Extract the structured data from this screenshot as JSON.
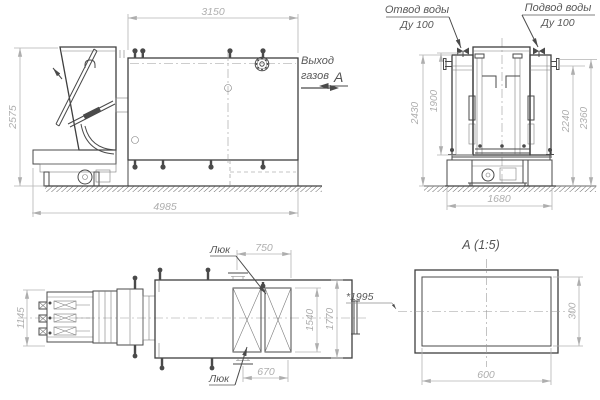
{
  "side": {
    "dim_top": "3150",
    "dim_height": "2575",
    "dim_length": "4985",
    "gas_out_1": "Выход",
    "gas_out_2": "газов",
    "view_letter": "А"
  },
  "end": {
    "outlet_label": "Отвод воды",
    "outlet_dn": "Ду 100",
    "inlet_label": "Подвод воды",
    "inlet_dn": "Ду 100",
    "dim_frame_height": "1900",
    "dim_total_height": "2430",
    "dim_body_height": "2240",
    "dim_top_height": "2360",
    "dim_foundation_width": "1680"
  },
  "plan": {
    "dim_feeder_width": "1145",
    "dim_hatch_top": "750",
    "dim_inner_width": "1540",
    "dim_outer_width": "1770",
    "dim_hatch_bottom": "670",
    "hatch_label_top": "Люк",
    "hatch_label_bottom": "Люк",
    "ref_length": "*1995"
  },
  "section": {
    "title": "А  (1:5)",
    "dim_width": "600",
    "dim_height": "300"
  },
  "colors": {
    "line": "#4a4a4a",
    "dimension": "#b4b4b4",
    "label": "#575757",
    "background": "#ffffff"
  }
}
